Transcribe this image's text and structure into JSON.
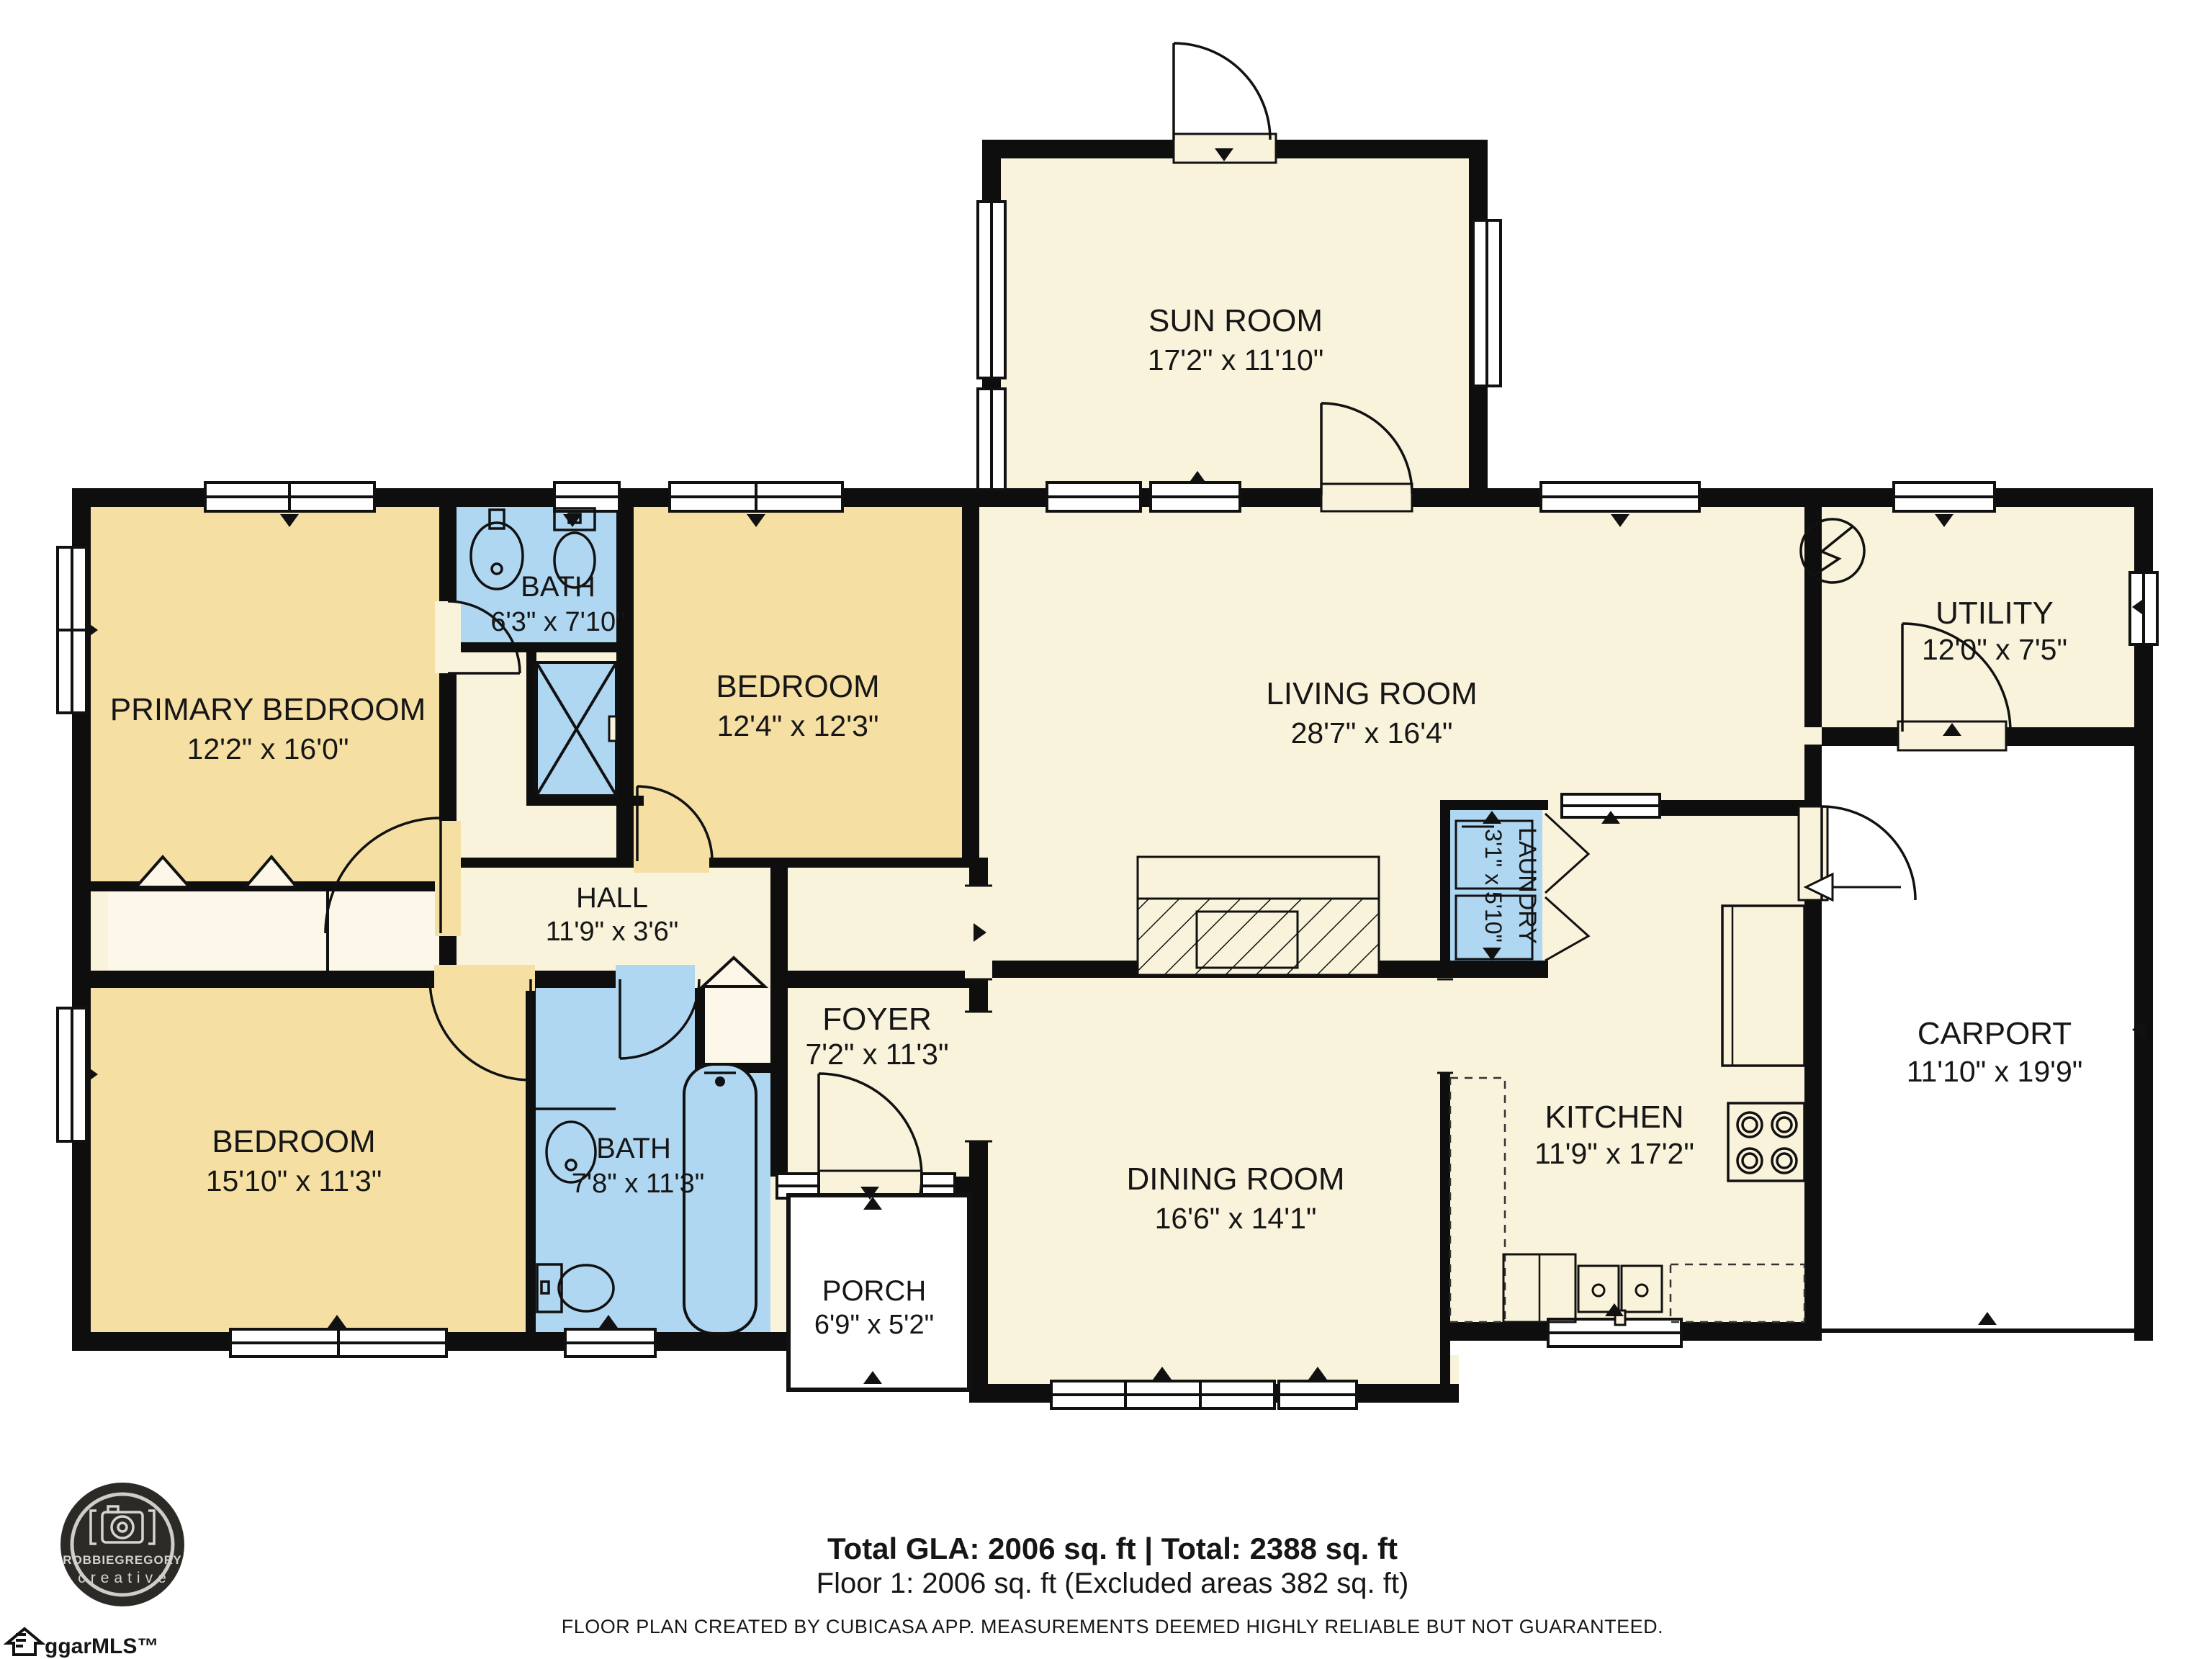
{
  "rooms": [
    {
      "id": "sun-room",
      "name": "SUN ROOM",
      "dims": "17'2\" x 11'10\""
    },
    {
      "id": "primary-bedroom",
      "name": "PRIMARY BEDROOM",
      "dims": "12'2\" x 16'0\""
    },
    {
      "id": "bath-top",
      "name": "BATH",
      "dims": "6'3\" x 7'10\""
    },
    {
      "id": "bedroom-top",
      "name": "BEDROOM",
      "dims": "12'4\" x 12'3\""
    },
    {
      "id": "living-room",
      "name": "LIVING ROOM",
      "dims": "28'7\" x 16'4\""
    },
    {
      "id": "utility",
      "name": "UTILITY",
      "dims": "12'0\" x 7'5\""
    },
    {
      "id": "hall",
      "name": "HALL",
      "dims": "11'9\" x 3'6\""
    },
    {
      "id": "laundry",
      "name": "LAUNDRY",
      "dims": "3'1\" x 5'10\""
    },
    {
      "id": "carport",
      "name": "CARPORT",
      "dims": "11'10\" x 19'9\""
    },
    {
      "id": "bedroom-left",
      "name": "BEDROOM",
      "dims": "15'10\" x 11'3\""
    },
    {
      "id": "bath-bottom",
      "name": "BATH",
      "dims": "7'8\" x 11'3\""
    },
    {
      "id": "foyer",
      "name": "FOYER",
      "dims": "7'2\" x 11'3\""
    },
    {
      "id": "dining-room",
      "name": "DINING ROOM",
      "dims": "16'6\" x 14'1\""
    },
    {
      "id": "kitchen",
      "name": "KITCHEN",
      "dims": "11'9\" x 17'2\""
    },
    {
      "id": "porch",
      "name": "PORCH",
      "dims": "6'9\" x 5'2\""
    }
  ],
  "footer": {
    "totals": "Total GLA: 2006 sq. ft | Total: 2388 sq. ft",
    "floor": "Floor 1: 2006 sq. ft (Excluded areas 382 sq. ft)",
    "disclaimer": "FLOOR PLAN CREATED BY CUBICASA APP. MEASUREMENTS DEEMED HIGHLY RELIABLE BUT NOT GUARANTEED."
  },
  "logo": {
    "line1": "ROBBIEGREGORY",
    "line2": "creative"
  },
  "watermark": "ggarMLS™",
  "colors": {
    "wall": "#0e0e0e",
    "room_cream": "#FAF3DC",
    "room_tan": "#F5DFA2",
    "room_blue": "#AFD7F2",
    "closet_light": "#FCF7E8",
    "outdoor_white": "#FFFFFF"
  }
}
